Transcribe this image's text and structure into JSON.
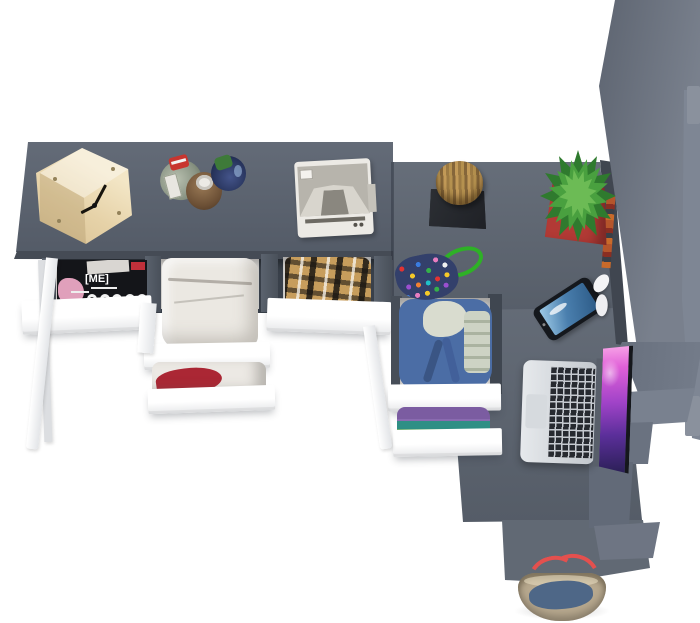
{
  "scene": {
    "description": "Top view 3D render of a grey home-office furniture set: desk with three open clothing drawers, side chest, tall wardrobe and accessories on a white floor",
    "background_color": "#ffffff",
    "palette": {
      "desk": "#5b6370",
      "desk_edge": "#454b55",
      "chest": "#5e6672",
      "return_desk": "#5c6470",
      "tongue": "#616974",
      "wardrobe": "#6a7280",
      "wardrobe_light": "#7e8694",
      "drawer_front": "#ffffff",
      "recess": "#39404a",
      "leg": "#f4f4f6",
      "wood": "#ecd9b0",
      "log": "#a9854b",
      "mat": "#27292e",
      "cactus": "#49a03f",
      "pot": "#b23a35",
      "cord": "#2eb126",
      "denim": "#4b6da5",
      "phone_screen": "#4a7fae",
      "laptop_screen": "#c24fd6",
      "bag_canvas": "#b7a88e",
      "bag_denim": "#4e6787",
      "bag_handle": "#e4504e"
    },
    "magazine": {
      "title_text": "[ME]"
    },
    "objects": [
      {
        "name": "wooden-cube-clock",
        "label": "Wooden cube clock",
        "color": "#ecd9b0"
      },
      {
        "name": "perfume-bottles",
        "label": "Three perfume bottles",
        "colors": [
          "#95a08e",
          "#7a5c42",
          "#2e3a5e"
        ]
      },
      {
        "name": "sewing-machine",
        "label": "White sewing machine",
        "color": "#e9e7e1"
      },
      {
        "name": "log-stool",
        "label": "Log stool on black mat",
        "color": "#a9854b"
      },
      {
        "name": "bead-pouch",
        "label": "Beaded pouch with green cord",
        "color": "#33406b"
      },
      {
        "name": "cactus-in-pot",
        "label": "Cactus in red pot",
        "colors": [
          "#49a03f",
          "#b23a35"
        ]
      },
      {
        "name": "smartphone",
        "label": "Smartphone with blue screen",
        "color": "#4a7fae"
      },
      {
        "name": "earphones",
        "label": "White earphones",
        "color": "#f4f4f6"
      },
      {
        "name": "laptop",
        "label": "Open laptop with purple wallpaper",
        "colors": [
          "#c9ced4",
          "#c24fd6"
        ]
      },
      {
        "name": "tote-bag",
        "label": "Canvas tote with denim and red handles",
        "colors": [
          "#b7a88e",
          "#4e6787",
          "#e4504e"
        ]
      },
      {
        "name": "magazines",
        "label": "Magazines in left drawer",
        "color": "#141519"
      },
      {
        "name": "white-trousers",
        "label": "Folded white trousers",
        "color": "#ebe8e2"
      },
      {
        "name": "plaid-shirt",
        "label": "Plaid shirt in drawer",
        "color": "#c79d5c"
      },
      {
        "name": "red-cloth",
        "label": "Red and white cloth",
        "color": "#ab2734"
      },
      {
        "name": "denim-hoodie",
        "label": "Denim hoodie in chest drawer",
        "color": "#4b6da5"
      },
      {
        "name": "folded-knitwear",
        "label": "Folded knitwear",
        "colors": [
          "#7b5ca1",
          "#2f8f85",
          "#4f9e55"
        ]
      },
      {
        "name": "books",
        "label": "Books on wardrobe shelf",
        "color": "#b5552b"
      }
    ]
  }
}
